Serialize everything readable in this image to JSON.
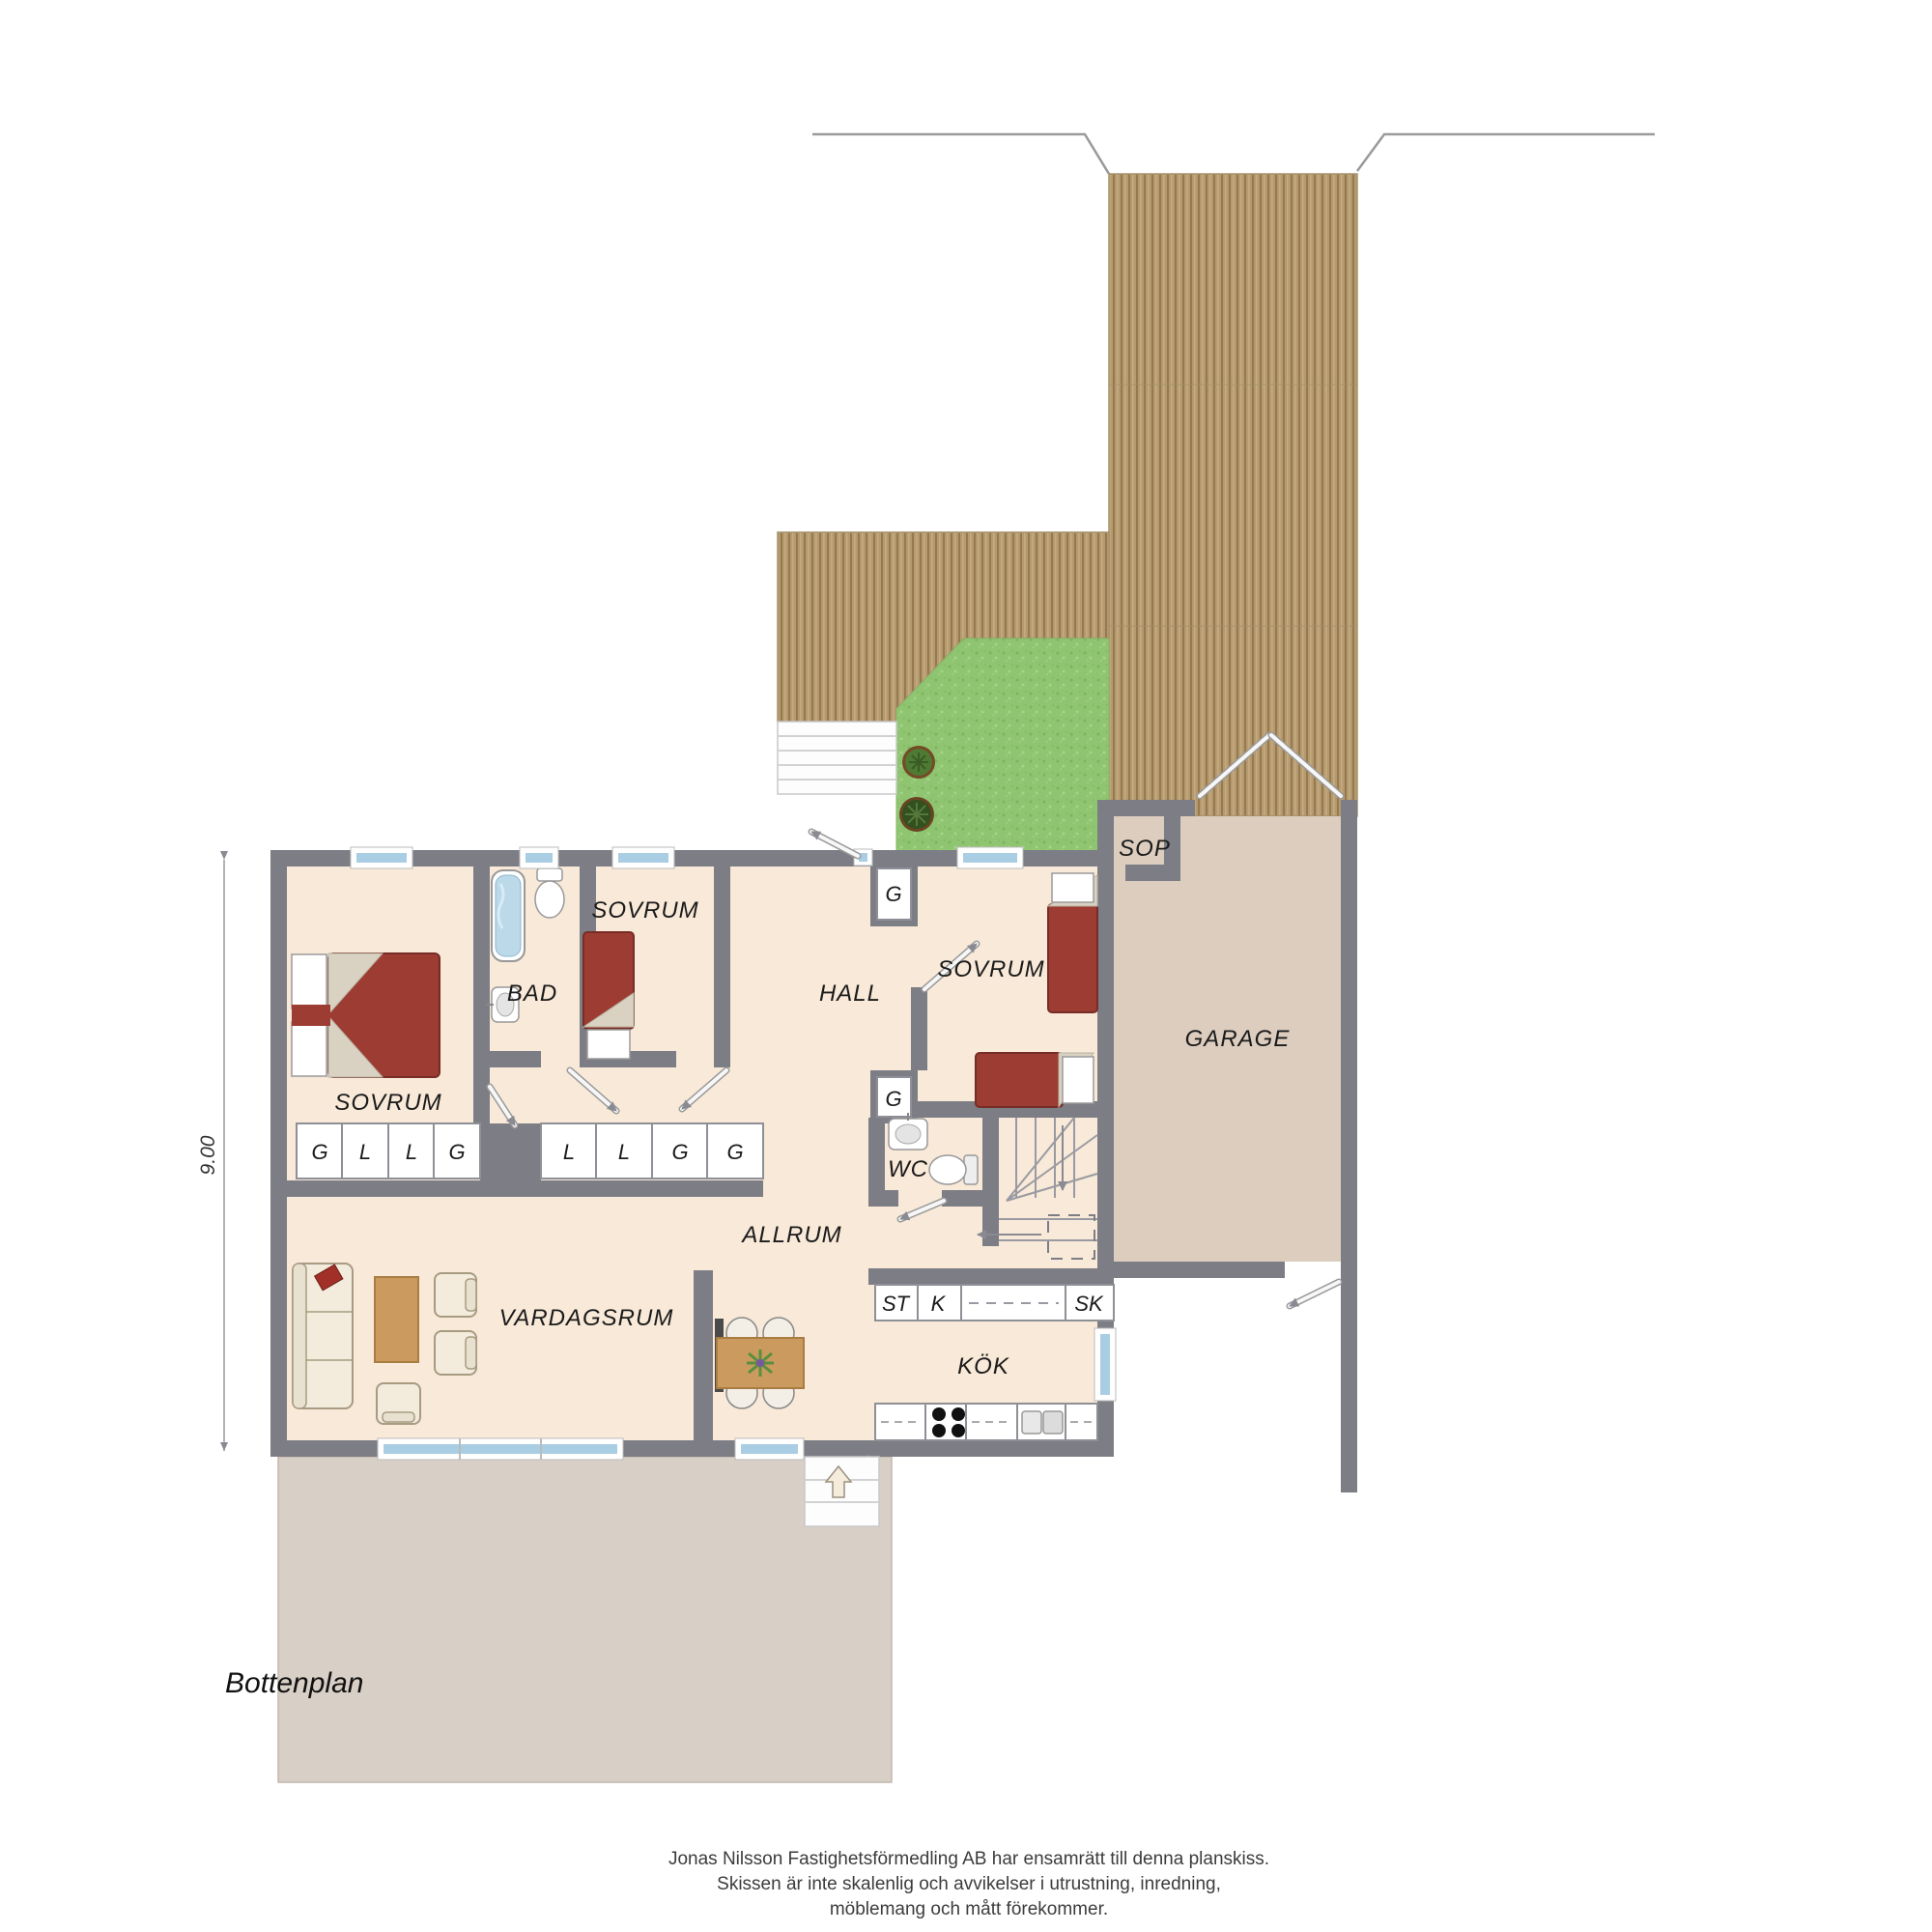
{
  "title": "Bottenplan",
  "dimension_label": "9.00",
  "rooms": {
    "sovrum1": "SOVRUM",
    "bad": "BAD",
    "sovrum2": "SOVRUM",
    "hall": "HALL",
    "sovrum3": "SOVRUM",
    "wc": "WC",
    "allrum": "ALLRUM",
    "vardagsrum": "VARDAGSRUM",
    "kok": "KÖK",
    "garage": "GARAGE",
    "sop": "SOP"
  },
  "closets": {
    "row1": [
      "G",
      "L",
      "L",
      "G"
    ],
    "row2": [
      "L",
      "L",
      "G",
      "G"
    ],
    "hall_upper": "G",
    "hall_lower": "G"
  },
  "kitchen_row": [
    "ST",
    "K",
    "SK"
  ],
  "footer": [
    "Jonas Nilsson Fastighetsförmedling AB har ensamrätt till denna planskiss.",
    "Skissen är inte skalenlig och avvikelser i utrustning, inredning,",
    "möblemang och mått förekommer."
  ],
  "colors": {
    "wall": "#7d7d85",
    "floor": "#f8e9d8",
    "garage_floor": "#dccdbf",
    "patio": "#d8cfc6",
    "window": "#a9cde3",
    "bed": "#9d3c33",
    "deck": "#b49a6e",
    "grass": "#8fc571"
  }
}
